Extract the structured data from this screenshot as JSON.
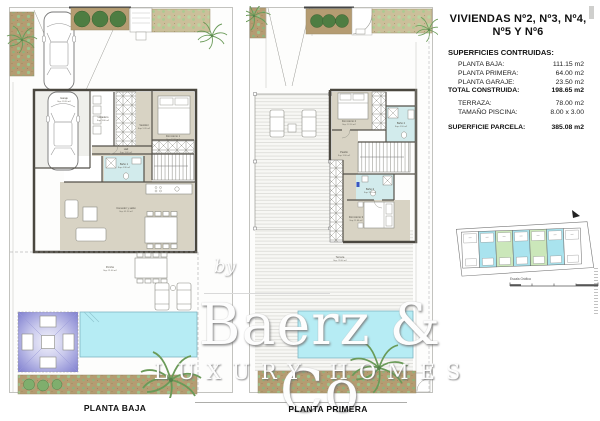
{
  "header": {
    "title_line1": "VIVIENDAS Nº2, Nº3, Nº4,",
    "title_line2": "Nº5 Y Nº6",
    "specs_heading": "SUPERFICIES CONTRUIDAS:",
    "specs": [
      {
        "label": "PLANTA BAJA:",
        "value": "111.15 m2"
      },
      {
        "label": "PLANTA PRIMERA:",
        "value": "64.00 m2"
      },
      {
        "label": "PLANTA GARAJE:",
        "value": "23.50 m2"
      },
      {
        "label": "TOTAL CONSTRUIDA:",
        "value": "198.65 m2"
      },
      {
        "label": "TERRAZA:",
        "value": "78.00 m2"
      },
      {
        "label": "TAMAÑO PISCINA:",
        "value": "8.00 x 3.00"
      },
      {
        "label": "SUPERFICIE PARCELA:",
        "value": "385.08 m2"
      }
    ]
  },
  "plans": {
    "left": {
      "caption": "PLANTA BAJA",
      "rooms": [
        {
          "name": "Garaje",
          "sup": "Sup: 23.50 m2"
        },
        {
          "name": "Lavadero",
          "sup": "Sup: 3.80 m2"
        },
        {
          "name": "Vestidor",
          "sup": "Sup: 5.20 m2"
        },
        {
          "name": "Dormitorio 1",
          "sup": "Sup: 12.40 m2"
        },
        {
          "name": "Baño 1",
          "sup": "Sup: 4.30 m2"
        },
        {
          "name": "Hall",
          "sup": "Sup: 3.60 m2"
        },
        {
          "name": "Comedor y salón",
          "sup": "Sup: 41.50 m2"
        },
        {
          "name": "Porche",
          "sup": "Sup: 21.00 m2"
        }
      ]
    },
    "right": {
      "caption": "PLANTA PRIMERA",
      "rooms": [
        {
          "name": "Dormitorio 2",
          "sup": "Sup: 12.10 m2"
        },
        {
          "name": "Baño 2",
          "sup": "Sup: 4.10 m2"
        },
        {
          "name": "Pasillo",
          "sup": "Sup: 3.90 m2"
        },
        {
          "name": "Baño 3",
          "sup": "Sup: 3.70 m2"
        },
        {
          "name": "Dormitorio 3",
          "sup": "Sup: 11.60 m2"
        },
        {
          "name": "Terraza",
          "sup": "Sup: 78.00 m2"
        }
      ]
    }
  },
  "watermark": {
    "by": "by",
    "brand": "Baerz & Co",
    "tagline": "LUXURY HOMES"
  },
  "key_plan": {
    "scale_label": "Escala Gráfica",
    "unit_colors": [
      "#ffffff",
      "#a9e3ee",
      "#cbe7ba",
      "#a9e3ee",
      "#cbe7ba",
      "#a9e3ee",
      "#ffffff"
    ]
  },
  "colors": {
    "pool": "#b6ecf4",
    "bathroom": "#d2ebec",
    "floor": "#d8d3c4",
    "wall": "#4a473f",
    "garden_soil": "#b59c72",
    "plant_green": "#6a9a58",
    "pergola_shade": "#8c8cd0"
  }
}
